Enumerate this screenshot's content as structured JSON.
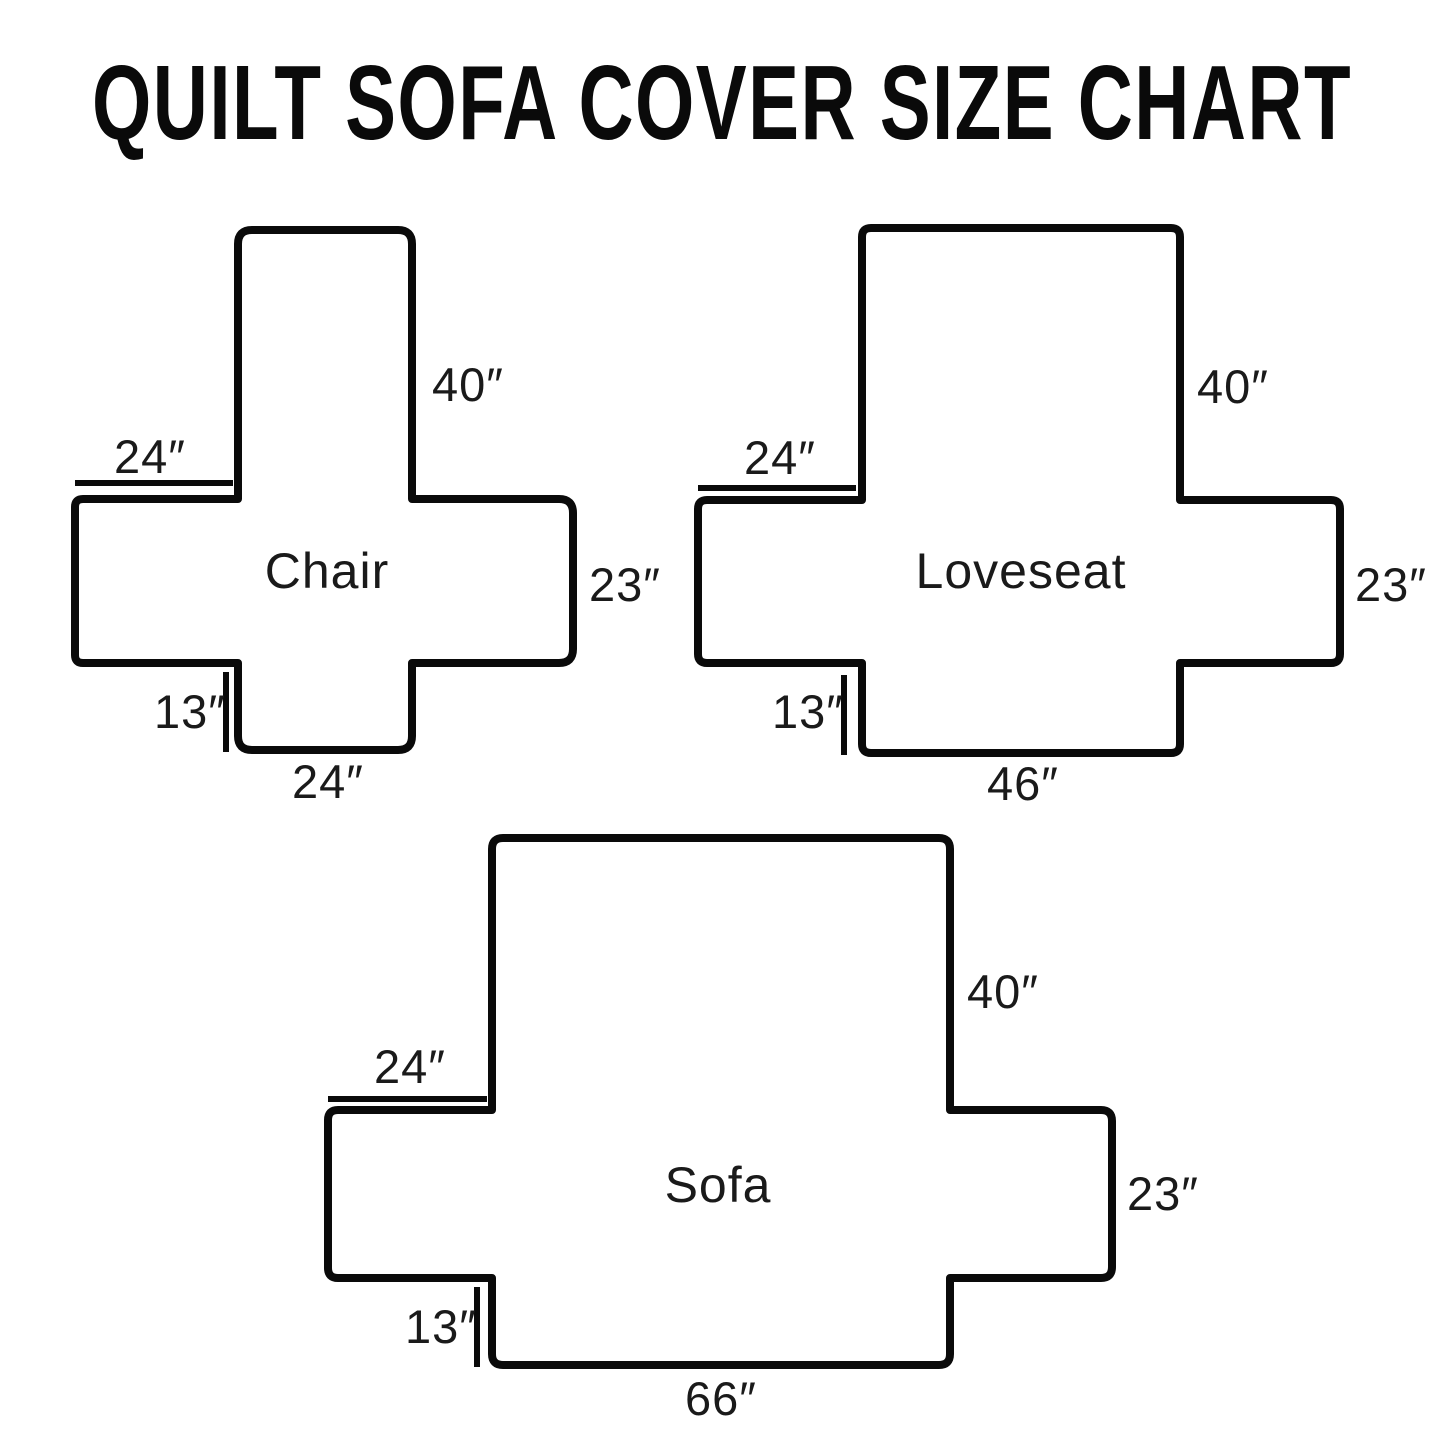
{
  "title": "QUILT SOFA COVER SIZE CHART",
  "colors": {
    "outline": "#0a0a0a",
    "label_text": "#1a1a1a",
    "background": "#ffffff"
  },
  "diagrams": [
    {
      "name": "Chair",
      "labels": {
        "back_height": "40″",
        "top_arm_width": "24″",
        "side_height": "23″",
        "front_skirt_height": "13″",
        "bottom_width": "24″"
      },
      "dimensions_inches": {
        "back_height": 40,
        "top_arm_width": 24,
        "side_height": 23,
        "front_skirt_height": 13,
        "bottom_width": 24
      },
      "geometry": {
        "back": {
          "x1": 238,
          "x2": 412,
          "top": 230
        },
        "band": {
          "x1": 75,
          "x2": 573,
          "top": 499,
          "bottom": 663
        },
        "front": {
          "x1": 238,
          "x2": 412,
          "bottom": 750
        },
        "outer_radius": 14,
        "left_radius": 8,
        "dim_top": {
          "y": 483,
          "x1": 75,
          "x2": 233
        },
        "dim_front": {
          "x": 226,
          "y1": 672,
          "y2": 752
        },
        "text_pos": {
          "back_height": [
            468,
            401
          ],
          "top_arm_width": [
            150,
            473
          ],
          "name": [
            327,
            588
          ],
          "side_height": [
            625,
            601
          ],
          "front_skirt_height": [
            190,
            728
          ],
          "bottom_width": [
            328,
            798
          ]
        }
      }
    },
    {
      "name": "Loveseat",
      "labels": {
        "back_height": "40″",
        "top_arm_width": "24″",
        "side_height": "23″",
        "front_skirt_height": "13″",
        "bottom_width": "46″"
      },
      "dimensions_inches": {
        "back_height": 40,
        "top_arm_width": 24,
        "side_height": 23,
        "front_skirt_height": 13,
        "bottom_width": 46
      },
      "geometry": {
        "back": {
          "x1": 862,
          "x2": 1180,
          "top": 228
        },
        "band": {
          "x1": 698,
          "x2": 1340,
          "top": 500,
          "bottom": 663
        },
        "front": {
          "x1": 862,
          "x2": 1180,
          "bottom": 753
        },
        "outer_radius": 9,
        "left_radius": 9,
        "dim_top": {
          "y": 488,
          "x1": 698,
          "x2": 856
        },
        "dim_front": {
          "x": 844,
          "y1": 675,
          "y2": 755
        },
        "text_pos": {
          "back_height": [
            1233,
            403
          ],
          "top_arm_width": [
            780,
            474
          ],
          "name": [
            1021,
            588
          ],
          "side_height": [
            1391,
            601
          ],
          "front_skirt_height": [
            808,
            728
          ],
          "bottom_width": [
            1023,
            800
          ]
        }
      }
    },
    {
      "name": "Sofa",
      "labels": {
        "back_height": "40″",
        "top_arm_width": "24″",
        "side_height": "23″",
        "front_skirt_height": "13″",
        "bottom_width": "66″"
      },
      "dimensions_inches": {
        "back_height": 40,
        "top_arm_width": 24,
        "side_height": 23,
        "front_skirt_height": 13,
        "bottom_width": 66
      },
      "geometry": {
        "back": {
          "x1": 492,
          "x2": 950,
          "top": 838
        },
        "band": {
          "x1": 328,
          "x2": 1112,
          "top": 1110,
          "bottom": 1278
        },
        "front": {
          "x1": 492,
          "x2": 950,
          "bottom": 1365
        },
        "outer_radius": 11,
        "left_radius": 10,
        "dim_top": {
          "y": 1099,
          "x1": 328,
          "x2": 487
        },
        "dim_front": {
          "x": 477,
          "y1": 1287,
          "y2": 1367
        },
        "text_pos": {
          "back_height": [
            1003,
            1008
          ],
          "top_arm_width": [
            410,
            1083
          ],
          "name": [
            718,
            1202
          ],
          "side_height": [
            1163,
            1210
          ],
          "front_skirt_height": [
            441,
            1343
          ],
          "bottom_width": [
            721,
            1415
          ]
        }
      }
    }
  ]
}
